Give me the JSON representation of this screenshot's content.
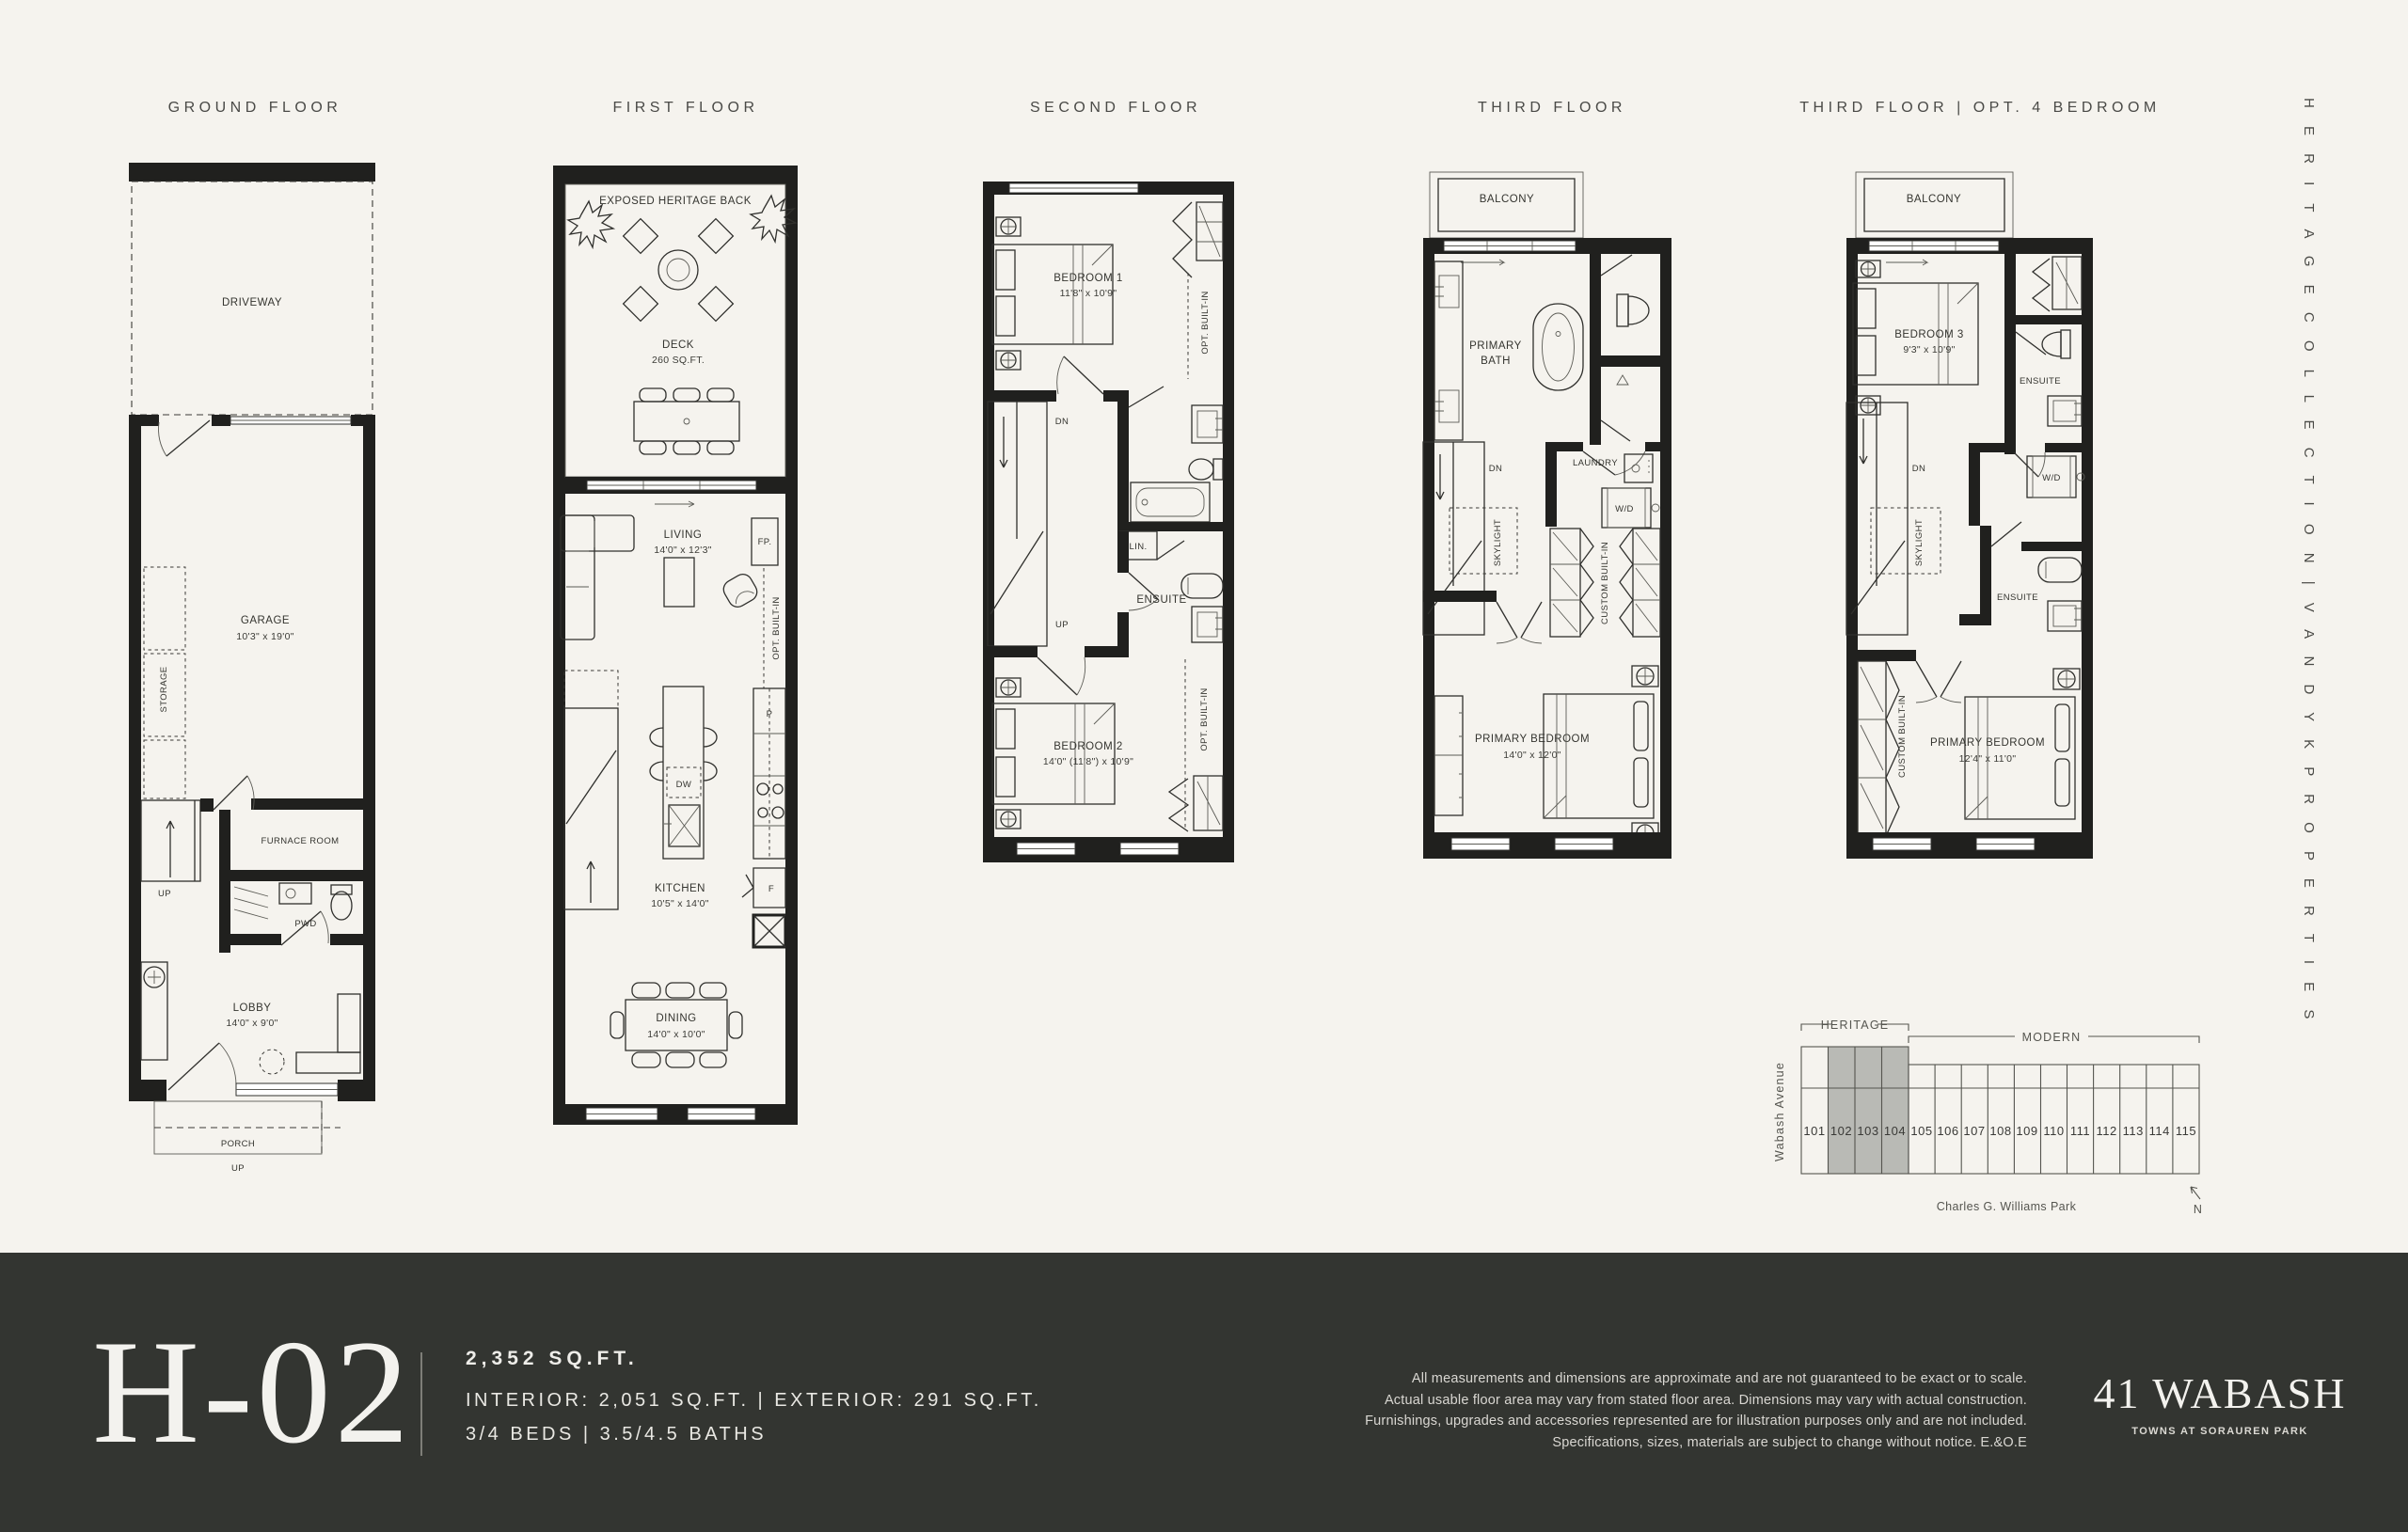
{
  "header": {
    "titles": [
      {
        "id": "ground",
        "label": "GROUND FLOOR"
      },
      {
        "id": "first",
        "label": "FIRST FLOOR"
      },
      {
        "id": "second",
        "label": "SECOND FLOOR"
      },
      {
        "id": "third",
        "label": "THIRD FLOOR"
      },
      {
        "id": "third_opt",
        "label": "THIRD FLOOR | OPT. 4 BEDROOM"
      }
    ],
    "side_rail": "H E R I T A G E   C O L L E C T I O N   |   V A N D Y K   P R O P E R T I E S"
  },
  "plans": {
    "ground": {
      "driveway": "DRIVEWAY",
      "garage": "GARAGE",
      "garage_dims": "10'3\" x 19'0\"",
      "storage": "STORAGE",
      "up_stairs": "UP",
      "furnace": "FURNACE ROOM",
      "pwd": "PWD",
      "lobby": "LOBBY",
      "lobby_dims": "14'0\" x 9'0\"",
      "porch": "PORCH",
      "porch_up": "UP"
    },
    "first": {
      "exposed": "EXPOSED HERITAGE BACK",
      "deck": "DECK",
      "deck_dims": "260 SQ.FT.",
      "living": "LIVING",
      "living_dims": "14'0\" x 12'3\"",
      "fireplace": "FP.",
      "opt_builtin": "OPT. BUILT-IN",
      "pantry": "P",
      "dishwasher": "DW",
      "fridge": "F",
      "kitchen": "KITCHEN",
      "kitchen_dims": "10'5\" x 14'0\"",
      "dining": "DINING",
      "dining_dims": "14'0\" x 10'0\""
    },
    "second": {
      "bedroom1": "BEDROOM 1",
      "bedroom1_dims": "11'8\" x 10'9\"",
      "opt_builtin_top": "OPT. BUILT-IN",
      "dn": "DN",
      "up": "UP",
      "linen": "LIN.",
      "ensuite": "ENSUITE",
      "bedroom2": "BEDROOM 2",
      "bedroom2_dims": "14'0\" (11'8\") x 10'9\"",
      "opt_builtin_bottom": "OPT. BUILT-IN"
    },
    "third": {
      "balcony": "BALCONY",
      "primary_bath_1": "PRIMARY",
      "primary_bath_2": "BATH",
      "laundry": "LAUNDRY",
      "wd": "W/D",
      "dn": "DN",
      "skylight": "SKYLIGHT",
      "custom_builtin": "CUSTOM BUILT-IN",
      "primary_bedroom": "PRIMARY BEDROOM",
      "primary_bedroom_dims": "14'0\" x 12'0\""
    },
    "third_opt": {
      "balcony": "BALCONY",
      "bedroom3": "BEDROOM 3",
      "bedroom3_dims": "9'3\" x 10'9\"",
      "ensuite_upper": "ENSUITE",
      "wd": "W/D",
      "dn": "DN",
      "skylight": "SKYLIGHT",
      "ensuite_lower": "ENSUITE",
      "custom_builtin": "CUSTOM BUILT-IN",
      "primary_bedroom": "PRIMARY BEDROOM",
      "primary_bedroom_dims": "12'4\" x 11'0\""
    }
  },
  "sitemap": {
    "heritage_label": "HERITAGE",
    "modern_label": "MODERN",
    "street": "Wabash Avenue",
    "park": "Charles G. Williams Park",
    "north": "N",
    "units": [
      "101",
      "102",
      "103",
      "104",
      "105",
      "106",
      "107",
      "108",
      "109",
      "110",
      "111",
      "112",
      "113",
      "114",
      "115"
    ],
    "highlighted_units": [
      "102",
      "103",
      "104"
    ],
    "highlight_color": "#b9bab5"
  },
  "footer": {
    "plan_code": "H-02",
    "total_area": "2,352 SQ.FT.",
    "interior_exterior": "INTERIOR: 2,051 SQ.FT.  |  EXTERIOR: 291 SQ.FT.",
    "beds_baths": "3/4 BEDS  |  3.5/4.5 BATHS",
    "disclaimer_1": "All measurements and dimensions are approximate and are not guaranteed to be exact or to scale.",
    "disclaimer_2": "Actual usable floor area may vary from stated floor area. Dimensions may vary with actual construction.",
    "disclaimer_3": "Furnishings, upgrades and accessories represented are for illustration purposes only and are not included.",
    "disclaimer_4": "Specifications, sizes, materials are subject to change without notice. E.&O.E",
    "logo": "41 WABASH",
    "logo_tagline": "TOWNS AT SORAUREN PARK",
    "bg": "#333531"
  },
  "canvas": {
    "bg": "#f5f3ee",
    "ink": "#20201e"
  }
}
